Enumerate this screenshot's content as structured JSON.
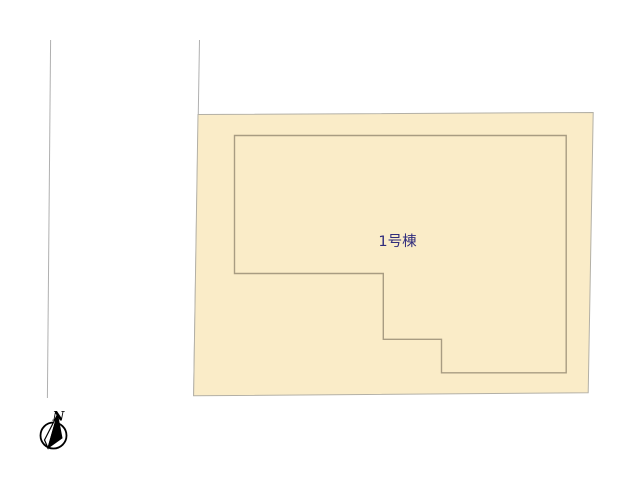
{
  "page": {
    "width": "640",
    "height": "480",
    "background": "#ffffff"
  },
  "site_plan": {
    "parcel": {
      "points": "198,114.5 593.2,112.5 588.2,392.8 193.6,395.8",
      "fill": "#faecc8",
      "stroke": "#b3b0a6"
    },
    "building": {
      "points": "234.5,135.5 566.2,135.5 566.2,372.8 441.5,372.8 441.5,339.3 383.3,339.3 383.3,273.5 234.5,273.5",
      "fill": "#faecc8",
      "stroke": "#a89c82",
      "label": "1号棟",
      "label_color": "#302c7c",
      "label_x": "397.5",
      "label_y": "246"
    },
    "boundary_lines": [
      {
        "x1": "50.6",
        "y1": "40",
        "x2": "47.4",
        "y2": "398",
        "stroke": "#b0b0b0"
      },
      {
        "x1": "199.5",
        "y1": "40",
        "x2": "193.6",
        "y2": "396",
        "stroke": "#b0b0b0"
      }
    ]
  },
  "compass": {
    "label": "N",
    "label_color": "#000000",
    "label_x": "58.5",
    "label_y": "420.5",
    "circle": {
      "cx": "53.5",
      "cy": "435.5",
      "r": "13"
    },
    "needle_dark_points": "57.5,414.5 62,438 48,448",
    "needle_light_points": "57.5,414.5 44.5,440 48,448",
    "stroke": "#000000",
    "dark_fill": "#000000",
    "light_fill": "#ffffff"
  }
}
